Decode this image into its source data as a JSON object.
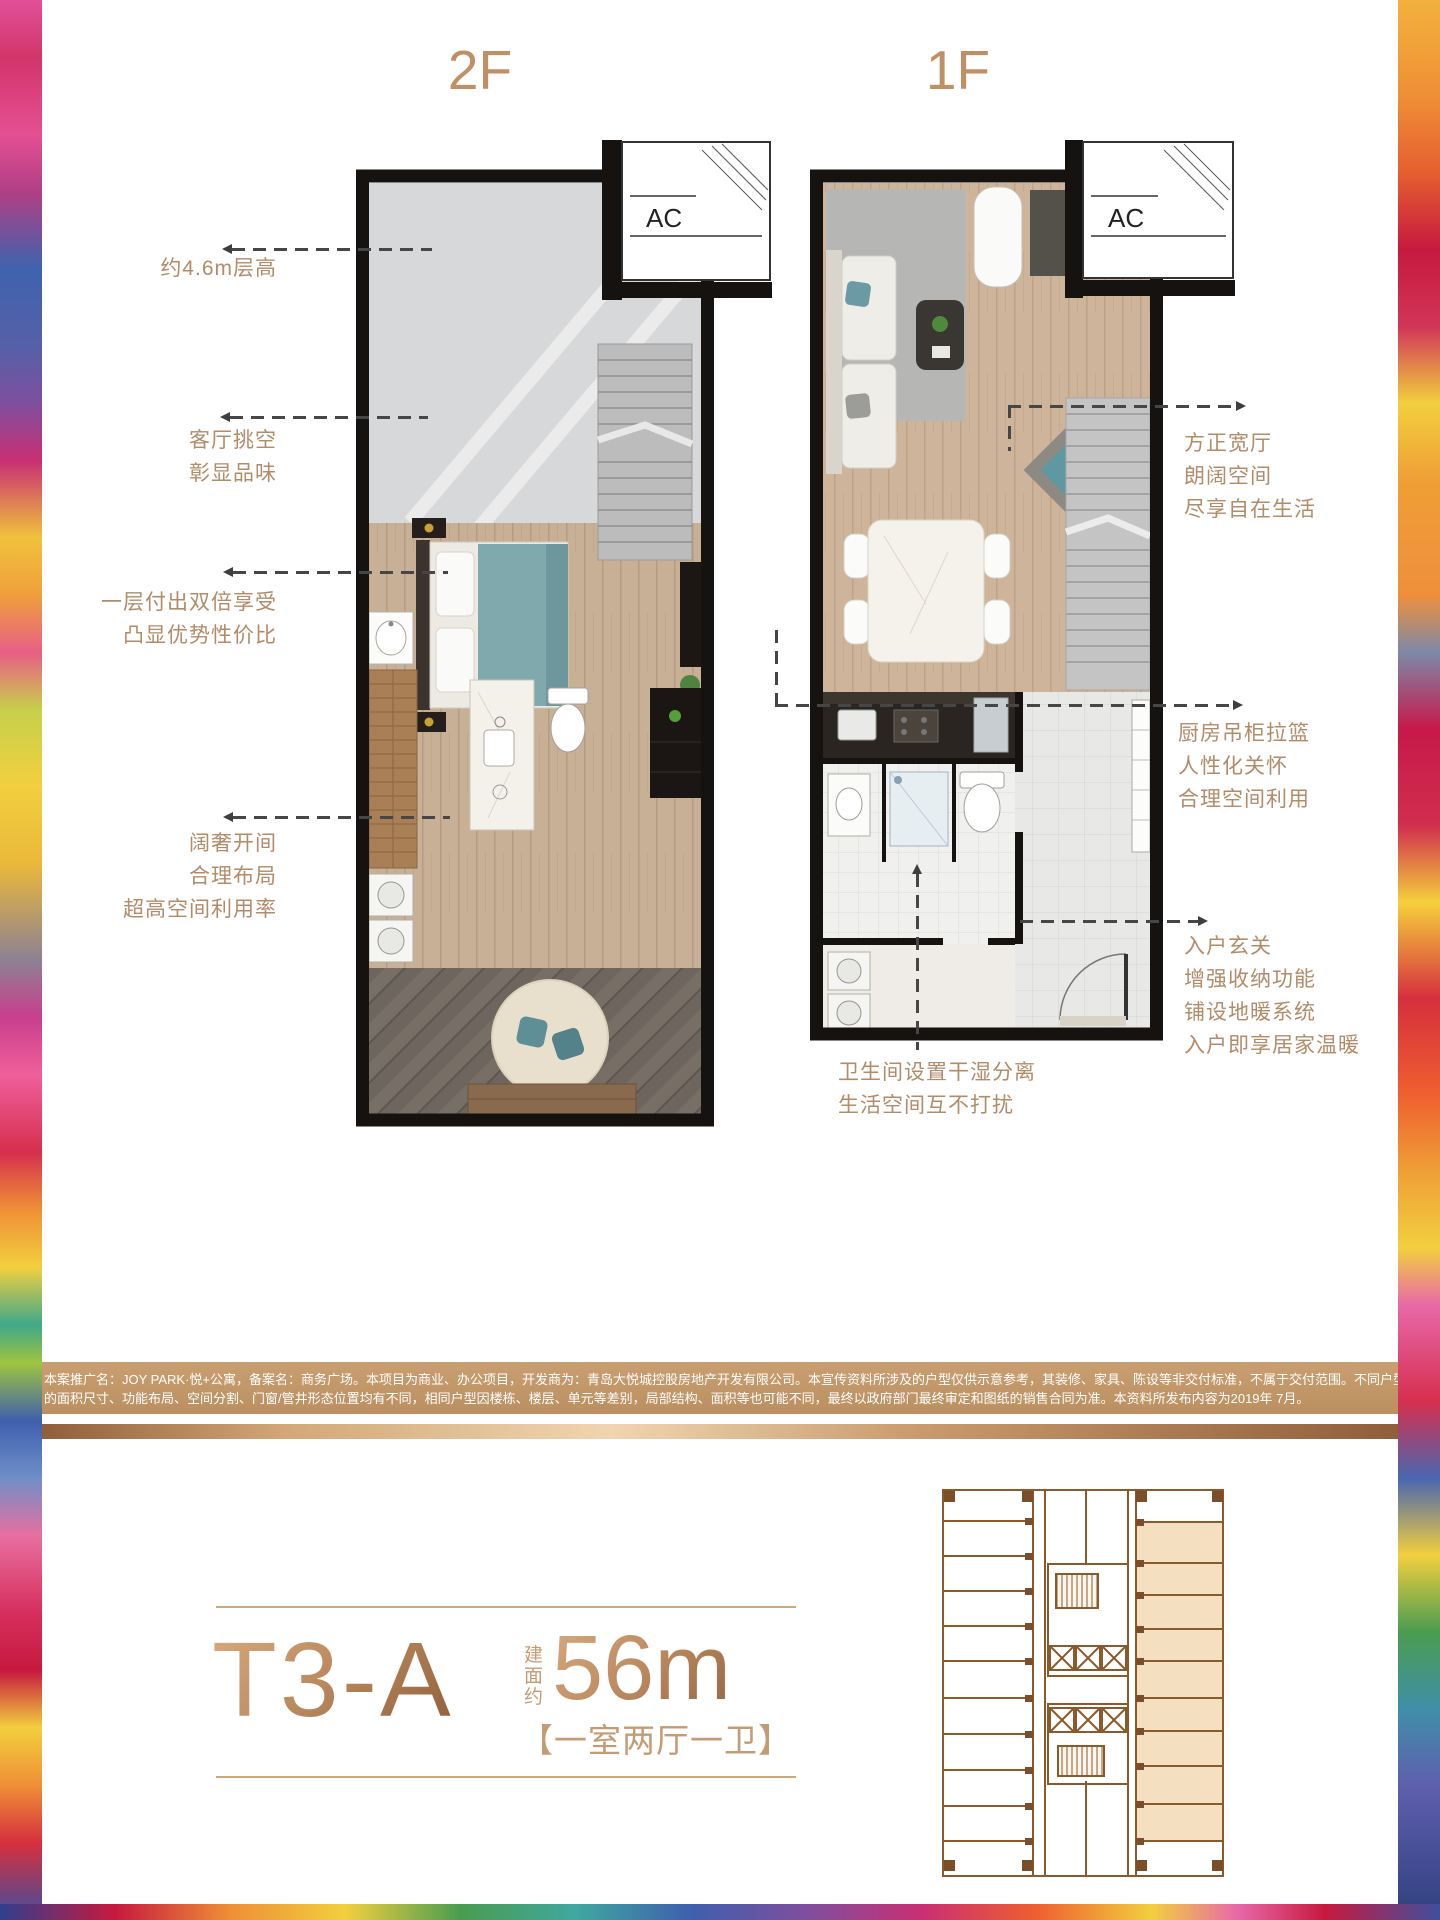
{
  "labels": {
    "floor_left": "2F",
    "floor_right": "1F",
    "ac": "AC"
  },
  "annotations": {
    "left": [
      {
        "lines": [
          "约4.6m层高"
        ]
      },
      {
        "lines": [
          "客厅挑空",
          "彰显品味"
        ]
      },
      {
        "lines": [
          "一层付出双倍享受",
          "凸显优势性价比"
        ]
      },
      {
        "lines": [
          "阔奢开间",
          "合理布局",
          "超高空间利用率"
        ]
      }
    ],
    "right": [
      {
        "lines": [
          "方正宽厅",
          "朗阔空间",
          "尽享自在生活"
        ]
      },
      {
        "lines": [
          "厨房吊柜拉篮",
          "人性化关怀",
          "合理空间利用"
        ]
      },
      {
        "lines": [
          "入户玄关",
          "增强收纳功能",
          "铺设地暖系统",
          "入户即享居家温暖"
        ]
      }
    ],
    "bottom": {
      "lines": [
        "卫生间设置干湿分离",
        "生活空间互不打扰"
      ]
    }
  },
  "disclaimer": {
    "line1": "本案推广名：JOY PARK·悦+公寓，备案名：商务广场。本项目为商业、办公项目，开发商为：青岛大悦城控股房地产开发有限公司。本宣传资料所涉及的户型仅供示意参考，其装修、家具、陈设等非交付标准，不属于交付范围。不同户型",
    "line2": "的面积尺寸、功能布局、空间分割、门窗/管井形态位置均有不同，相同户型因楼栋、楼层、单元等差别，局部结构、面积等也可能不同，最终以政府部门最终审定和图纸的销售合同为准。本资料所发布内容为2019年 7月。"
  },
  "unit_card": {
    "model": "T3-A",
    "area_label": "建面约",
    "area_value": "56m",
    "area_sup": "2",
    "layout": "【一室两厅一卫】"
  },
  "colors": {
    "bronze_text": "#b28b68",
    "bronze_title": "#c08f63",
    "leader": "#464646",
    "keyplan_line": "#8a5a2b",
    "keyplan_highlight": "#f4dfc0",
    "disclaimer_bar": "#c49a6c"
  }
}
